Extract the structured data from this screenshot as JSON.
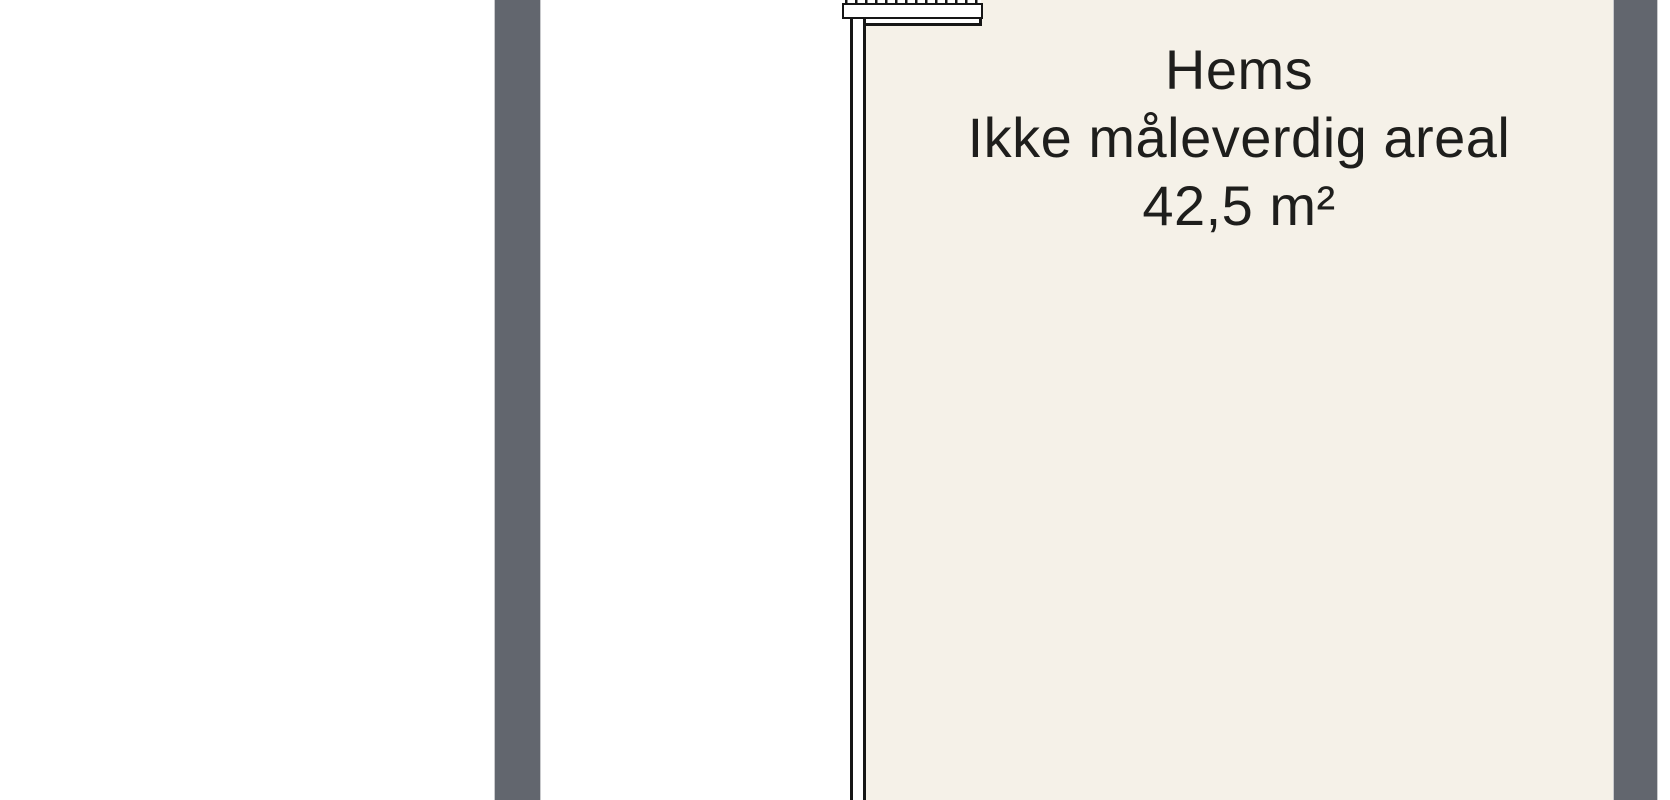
{
  "room": {
    "name": "Hems",
    "note": "Ikke måleverdig areal",
    "area": "42,5 m²"
  },
  "colors": {
    "background": "#ffffff",
    "wall_dark": "#62666e",
    "room_fill": "#f5f1e8",
    "outline": "#161616",
    "text": "#1e1e1c"
  }
}
